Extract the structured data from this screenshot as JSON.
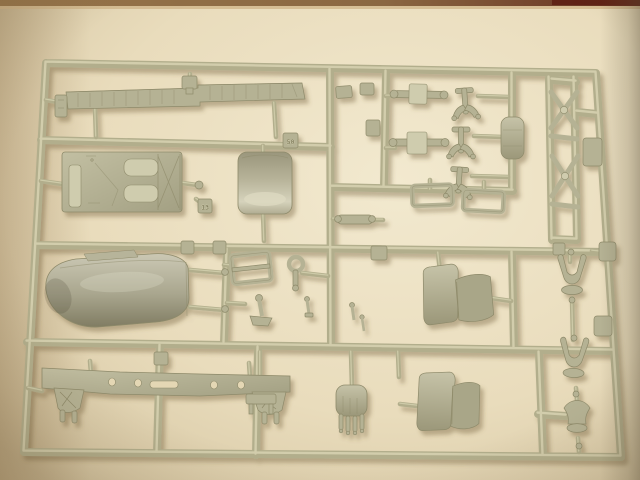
{
  "scene": {
    "type": "photograph",
    "subject": "injection-molded plastic model kit sprue with unpainted military-truck parts",
    "setting": "grey-olive styrene runner frame lying on cream paper, warm tungsten light, dark red-brown table edge along top border",
    "sprue_shape": "rectangular outer runner frame, slightly skewed by camera perspective, divided by inner runners into rows of parts"
  },
  "palette": {
    "bg_light": "#f2e9cf",
    "bg_mid": "#e4d7b4",
    "bg_dark": "#cdbd9b",
    "sprue_light": "#d9d5b4",
    "sprue_mid": "#b2ae8c",
    "sprue_dark": "#827e5e",
    "part_light": "#cfccae",
    "part_mid": "#b5b294",
    "part_dark": "#8e8a6a",
    "band_brown": "#8a6742",
    "band_maroon": "#61211430",
    "shadow_brown": "#6b5632"
  },
  "tabs": {
    "tab_50": "50",
    "tab_13": "13"
  },
  "parts": [
    {
      "name": "running-board",
      "desc": "long stepped tread strip with panel lines, top row"
    },
    {
      "name": "floor-plate",
      "desc": "rectangular cab floor panel with hatches and X-ribbed end"
    },
    {
      "name": "cowl",
      "desc": "small curved cowl / hood top panel"
    },
    {
      "name": "hood",
      "desc": "large one-piece rounded engine bonnet"
    },
    {
      "name": "chassis-rail",
      "desc": "long frame side rail with lightening holes and end gussets"
    },
    {
      "name": "seat-1",
      "desc": "two-panel seat with backrest"
    },
    {
      "name": "seat-2",
      "desc": "two-panel seat with backrest"
    },
    {
      "name": "engine-block",
      "desc": "rounded block with four exhaust stubs"
    },
    {
      "name": "ladder-crossmembers",
      "desc": "frame rails with X cross braces"
    },
    {
      "name": "axle-1",
      "desc": "axle with central differential housing"
    },
    {
      "name": "axle-2",
      "desc": "axle with central differential housing"
    },
    {
      "name": "spring-hangers",
      "desc": "three anchor-shaped spring hanger brackets"
    },
    {
      "name": "fuel-tank",
      "desc": "small rounded tank"
    },
    {
      "name": "windshield-frame",
      "desc": "open rectangular frame with crossbar"
    },
    {
      "name": "steering-column",
      "desc": "column with flared base"
    },
    {
      "name": "axle-fork-chain",
      "desc": "column of U-shaped fork / spring parts on right runner"
    },
    {
      "name": "number-tabs",
      "desc": "molded part-number tabs 50 and 13"
    }
  ]
}
